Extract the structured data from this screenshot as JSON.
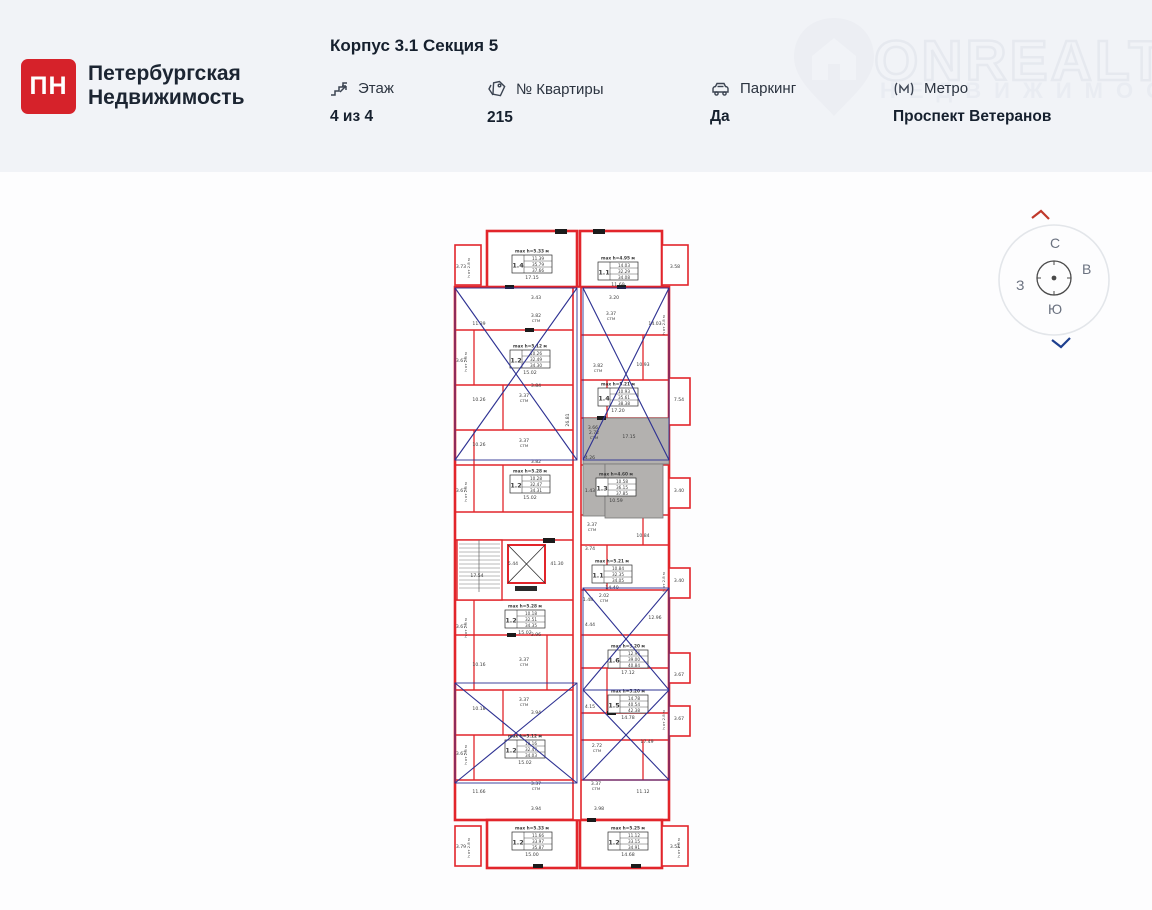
{
  "header": {
    "logo": {
      "mark": "ПН",
      "line1": "Петербургская",
      "line2": "Недвижимость"
    },
    "title": "Корпус 3.1 Секция 5",
    "info": [
      {
        "label": "Этаж",
        "value": "4 из 4",
        "icon": "stairs-icon"
      },
      {
        "label": "№ Квартиры",
        "value": "215",
        "icon": "tag-icon"
      },
      {
        "label": "Паркинг",
        "value": "Да",
        "icon": "car-icon"
      },
      {
        "label": "Метро",
        "value": "Проспект Ветеранов",
        "icon": "metro-icon"
      }
    ],
    "watermark": {
      "brand": "ONREALT",
      "sub": "НЕДВИЖИМОСТЬ"
    }
  },
  "compass": {
    "north": "С",
    "east": "В",
    "west": "З",
    "south": "Ю"
  },
  "floor_plan": {
    "colors": {
      "wall": "#e2252b",
      "crossout": "#2d3192",
      "selected_fill": "#b3b1af",
      "text": "#3a3a3a"
    },
    "apartments": [
      {
        "unit": "1.4",
        "max_height": "max h=5.33 м",
        "areas": [
          "11.39",
          "35.79",
          "37.66"
        ],
        "room": "17.15",
        "x": 65,
        "y": 27,
        "selected": false
      },
      {
        "unit": "1.1",
        "max_height": "max h=4.95 м",
        "areas": [
          "14.03",
          "32.29",
          "34.08"
        ],
        "room": "11.69",
        "x": 151,
        "y": 34,
        "selected": false
      },
      {
        "unit": "1.2",
        "max_height": "max h=5.12 м",
        "areas": [
          "10.26",
          "32.49",
          "34.30"
        ],
        "room": "15.02",
        "x": 63,
        "y": 122,
        "selected": false
      },
      {
        "unit": "1.4",
        "max_height": "max h=5.21 м",
        "areas": [
          "10.93",
          "35.61",
          "38.38"
        ],
        "room": "17.20",
        "x": 151,
        "y": 160,
        "selected": false
      },
      {
        "unit": "1.3",
        "max_height": "max h=4.60 м",
        "areas": [
          "10.58",
          "36.15",
          "37.85"
        ],
        "room": "10.59",
        "x": 149,
        "y": 250,
        "selected": true
      },
      {
        "unit": "1.2",
        "max_height": "max h=5.28 м",
        "areas": [
          "10.28",
          "32.47",
          "34.31"
        ],
        "room": "15.02",
        "x": 63,
        "y": 247,
        "selected": false
      },
      {
        "unit": "1.1",
        "max_height": "max h=5.21 м",
        "areas": [
          "10.84",
          "32.35",
          "34.05"
        ],
        "room": "14.40",
        "x": 145,
        "y": 337,
        "selected": false
      },
      {
        "unit": "1.2",
        "max_height": "max h=5.28 м",
        "areas": [
          "10.18",
          "32.51",
          "34.35"
        ],
        "room": "15.02",
        "x": 58,
        "y": 382,
        "selected": false
      },
      {
        "unit": "1.6",
        "max_height": "max h=5.20 м",
        "areas": [
          "12.96",
          "39.00",
          "40.84"
        ],
        "room": "17.12",
        "x": 161,
        "y": 422,
        "selected": false
      },
      {
        "unit": "1.5",
        "max_height": "max h=5.20 м",
        "areas": [
          "14.78",
          "40.54",
          "42.38"
        ],
        "room": "14.78",
        "x": 161,
        "y": 467,
        "selected": false
      },
      {
        "unit": "1.2",
        "max_height": "max h=5.12 м",
        "areas": [
          "10.16",
          "32.47",
          "34.03"
        ],
        "room": "15.02",
        "x": 58,
        "y": 512,
        "selected": false
      },
      {
        "unit": "1.2",
        "max_height": "max h=5.33 м",
        "areas": [
          "11.66",
          "33.97",
          "35.87"
        ],
        "room": "15.00",
        "x": 65,
        "y": 604,
        "selected": false
      },
      {
        "unit": "1.2",
        "max_height": "max h=5.25 м",
        "areas": [
          "11.12",
          "33.15",
          "34.91"
        ],
        "room": "14.68",
        "x": 161,
        "y": 604,
        "selected": false
      }
    ],
    "dimensions": [
      {
        "t": "3.73",
        "x": 14,
        "y": 40
      },
      {
        "t": "3.58",
        "x": 228,
        "y": 40
      },
      {
        "t": "3.43",
        "x": 89,
        "y": 71
      },
      {
        "t": "3.20",
        "x": 167,
        "y": 71
      },
      {
        "t": "3.82",
        "s": "СТМ",
        "x": 89,
        "y": 89
      },
      {
        "t": "3.37",
        "s": "СТМ",
        "x": 164,
        "y": 87
      },
      {
        "t": "11.39",
        "x": 32,
        "y": 97
      },
      {
        "t": "14.03",
        "x": 208,
        "y": 97
      },
      {
        "t": "3.67",
        "x": 14,
        "y": 134
      },
      {
        "t": "3.82",
        "s": "СТМ",
        "x": 151,
        "y": 139
      },
      {
        "t": "10.93",
        "x": 196,
        "y": 138
      },
      {
        "t": "3.84",
        "x": 89,
        "y": 159
      },
      {
        "t": "10.26",
        "x": 32,
        "y": 173
      },
      {
        "t": "3.37",
        "s": "СТМ",
        "x": 77,
        "y": 169
      },
      {
        "t": "7.54",
        "x": 232,
        "y": 173
      },
      {
        "t": "26.81",
        "x": 122,
        "y": 192,
        "v": 1
      },
      {
        "t": "3.66",
        "x": 146,
        "y": 201
      },
      {
        "t": "10.26",
        "x": 32,
        "y": 218
      },
      {
        "t": "3.37",
        "s": "СТМ",
        "x": 77,
        "y": 214
      },
      {
        "t": "17.15",
        "x": 182,
        "y": 210
      },
      {
        "t": "2.72",
        "s": "СТМ",
        "x": 147,
        "y": 206
      },
      {
        "t": "3.82",
        "x": 89,
        "y": 235
      },
      {
        "t": "4.26",
        "x": 143,
        "y": 231
      },
      {
        "t": "1.43",
        "x": 143,
        "y": 264
      },
      {
        "t": "3.40",
        "x": 232,
        "y": 264
      },
      {
        "t": "3.67",
        "x": 14,
        "y": 264
      },
      {
        "t": "3.37",
        "s": "СТМ",
        "x": 145,
        "y": 298
      },
      {
        "t": "10.84",
        "x": 196,
        "y": 309
      },
      {
        "t": "3.74",
        "x": 143,
        "y": 322
      },
      {
        "t": "5.44",
        "x": 66,
        "y": 337
      },
      {
        "t": "41.30",
        "x": 110,
        "y": 337
      },
      {
        "t": "17.54",
        "x": 30,
        "y": 349
      },
      {
        "t": "3.40",
        "x": 232,
        "y": 354
      },
      {
        "t": "2.02",
        "s": "СТМ",
        "x": 157,
        "y": 369
      },
      {
        "t": "1.48",
        "x": 141,
        "y": 373
      },
      {
        "t": "12.96",
        "x": 208,
        "y": 391
      },
      {
        "t": "4.44",
        "x": 143,
        "y": 398
      },
      {
        "t": "3.67",
        "x": 14,
        "y": 400
      },
      {
        "t": "3.96",
        "x": 89,
        "y": 408
      },
      {
        "t": "10.16",
        "x": 32,
        "y": 438
      },
      {
        "t": "3.37",
        "s": "СТМ",
        "x": 77,
        "y": 433
      },
      {
        "t": "3.67",
        "x": 232,
        "y": 448
      },
      {
        "t": "4.15",
        "x": 143,
        "y": 480
      },
      {
        "t": "3.37",
        "s": "СТМ",
        "x": 77,
        "y": 473
      },
      {
        "t": "3.67",
        "x": 232,
        "y": 492
      },
      {
        "t": "10.18",
        "x": 32,
        "y": 482
      },
      {
        "t": "3.94",
        "x": 89,
        "y": 486
      },
      {
        "t": "17.49",
        "x": 200,
        "y": 515
      },
      {
        "t": "2.72",
        "s": "СТМ",
        "x": 150,
        "y": 519
      },
      {
        "t": "3.67",
        "x": 14,
        "y": 527
      },
      {
        "t": "11.66",
        "x": 32,
        "y": 565
      },
      {
        "t": "3.37",
        "s": "СТМ",
        "x": 89,
        "y": 557
      },
      {
        "t": "3.37",
        "s": "СТМ",
        "x": 149,
        "y": 557
      },
      {
        "t": "11.12",
        "x": 196,
        "y": 565
      },
      {
        "t": "3.94",
        "x": 89,
        "y": 582
      },
      {
        "t": "3.98",
        "x": 152,
        "y": 582
      },
      {
        "t": "3.79",
        "x": 14,
        "y": 620
      },
      {
        "t": "3.51",
        "x": 228,
        "y": 620
      },
      {
        "t": "h от 2.8 м",
        "x": 23,
        "y": 40,
        "v": 1
      },
      {
        "t": "h от 2.8 м",
        "x": 20,
        "y": 134,
        "v": 1
      },
      {
        "t": "h от 2.8 м",
        "x": 20,
        "y": 264,
        "v": 1
      },
      {
        "t": "h от 2.8 м",
        "x": 20,
        "y": 400,
        "v": 1
      },
      {
        "t": "h от 2.8 м",
        "x": 20,
        "y": 527,
        "v": 1
      },
      {
        "t": "h от 2.8 м",
        "x": 218,
        "y": 97,
        "v": 1
      },
      {
        "t": "h от 2.8 м",
        "x": 218,
        "y": 354,
        "v": 1
      },
      {
        "t": "h от 2.8 м",
        "x": 218,
        "y": 492,
        "v": 1
      },
      {
        "t": "h от 2.8 м",
        "x": 23,
        "y": 620,
        "v": 1
      },
      {
        "t": "h от 2.8 м",
        "x": 233,
        "y": 620,
        "v": 1
      }
    ],
    "crossed_zones": [
      [
        8,
        60,
        122,
        172
      ],
      [
        136,
        60,
        86,
        172
      ],
      [
        136,
        360,
        86,
        102
      ],
      [
        136,
        462,
        86,
        90
      ],
      [
        8,
        455,
        122,
        100
      ]
    ]
  }
}
